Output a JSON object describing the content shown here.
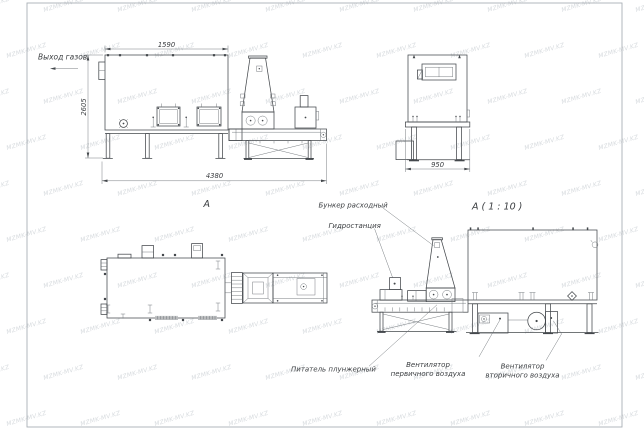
{
  "watermark": {
    "text": "MZMK-MV.KZ"
  },
  "labels": {
    "gas_outlet": "Выход газов",
    "view_arrow": "А",
    "detail_view": "А ( 1 : 10 )",
    "feed_hopper": "Бункер расходный",
    "hydraulic_station": "Гидростанция",
    "plunger_feeder": "Питатель плунжерный",
    "primary_fan_line1": "Вентилятор",
    "primary_fan_line2": "первичного воздуха",
    "secondary_fan_line1": "Вентилятор",
    "secondary_fan_line2": "вторичного воздуха"
  },
  "dimensions": {
    "front_width": "1590",
    "front_height": "2605",
    "overall_length": "4380",
    "end_width": "950"
  },
  "colors": {
    "line": "#44484c",
    "thin_line": "#6a6f74",
    "text": "#3a3d40",
    "frame": "#aab0b5",
    "watermark": "#aeb6bd",
    "background": "#ffffff"
  }
}
